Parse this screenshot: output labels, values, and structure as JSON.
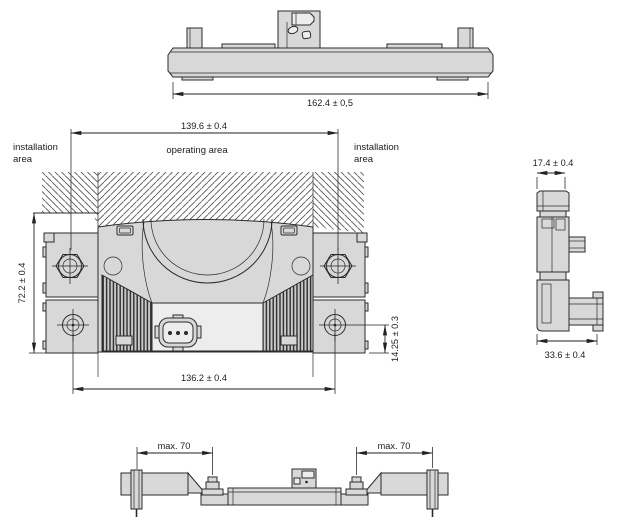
{
  "drawing": {
    "colors": {
      "part_fill": "#d8d8d8",
      "line": "#2b2b2b",
      "hatch": "#4f4f4f",
      "background": "#ffffff"
    },
    "views": {
      "top_view": {
        "dim_overall_width": "162.4 ± 0,5"
      },
      "front_view": {
        "dim_mount_width_upper": "139.6 ± 0.4",
        "dim_mount_width_lower": "136.2 ± 0.4",
        "dim_overall_height": "72.2 ± 0.4",
        "dim_hole_to_bottom": "14.25 ± 0.3",
        "labels": {
          "installation_left": {
            "line1": "installation",
            "line2": "area"
          },
          "operating": "operating area",
          "installation_right": {
            "line1": "installation",
            "line2": "area"
          }
        }
      },
      "side_view": {
        "dim_top_width": "17.4 ± 0.4",
        "dim_overall_depth": "33.6 ± 0.4"
      },
      "bottom_view": {
        "dim_clearance_left": "max. 70",
        "dim_clearance_right": "max. 70"
      }
    }
  }
}
